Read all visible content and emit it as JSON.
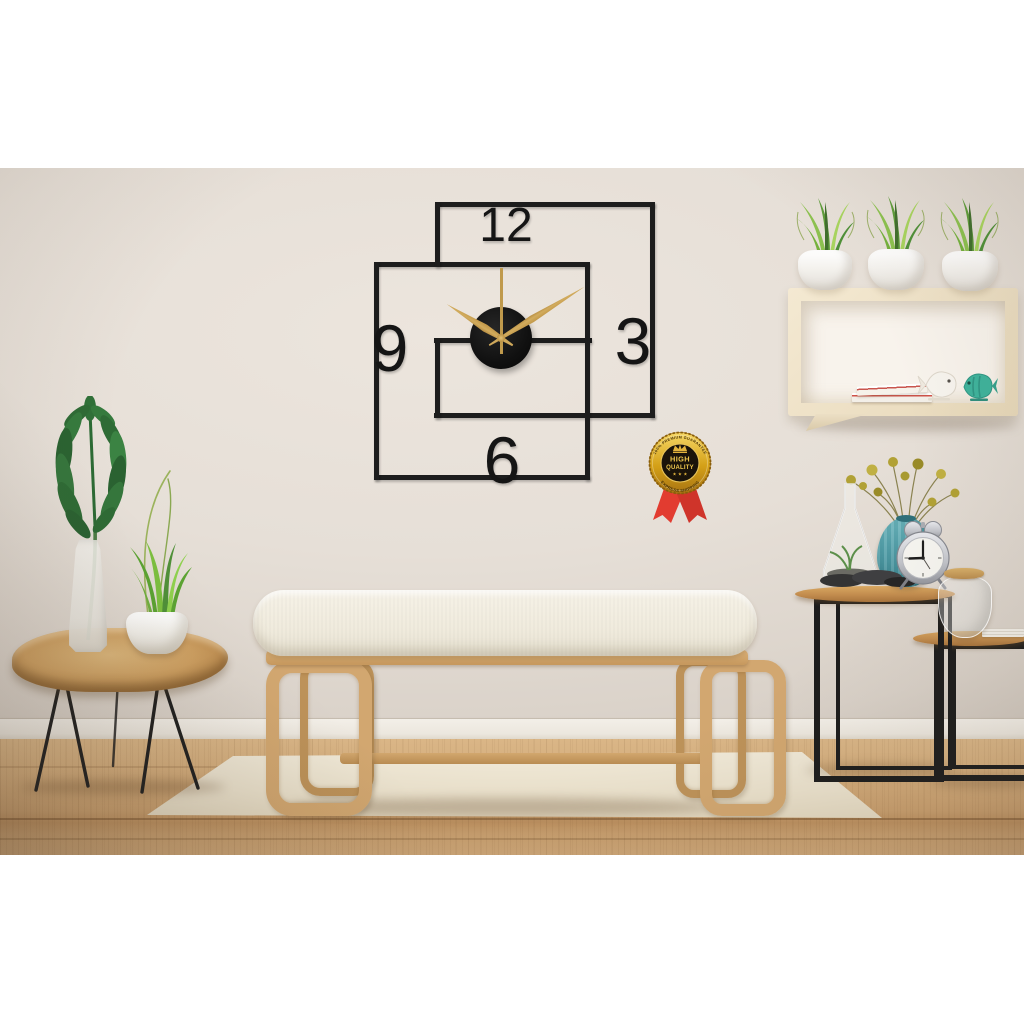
{
  "photo": {
    "wall_clock": {
      "numerals": {
        "twelve": "12",
        "three": "3",
        "six": "6",
        "nine": "9"
      },
      "time": {
        "hour": 10,
        "minute": 9,
        "second": 0
      },
      "frame_color": "#1d1d1d",
      "hands_color": "#c09a4c",
      "disc_color": "#121212"
    },
    "badge": {
      "arc_top": "100% PREMIUM GUARANTEE",
      "title_line1": "HIGH",
      "title_line2": "QUALITY",
      "stars": "★ ★ ★",
      "arc_bottom": "EXPRESS SHIPPING",
      "gold": "#d4a017",
      "ribbon_red": "#e23c30",
      "center_dark": "#1a130a"
    },
    "alarm_clock": {
      "time_shown": "9:00"
    },
    "palette": {
      "wall": "#e6dfd7",
      "skirting": "#f0ece5",
      "floor_wood": "#cfa674",
      "rug": "#ebe2cd",
      "bench_wood": "#d2a770",
      "cushion": "#f2eee2",
      "shelf_wood": "#eee0c6",
      "side_table_wood": "#c28c4e",
      "metal_leg_black": "#1c1c1c",
      "monstera_green": "#2e6b35",
      "grass_green": "#7cb844",
      "vase_teal": "#4d9aa4",
      "flower_yellow": "#b1a135",
      "alarm_silver": "#c9cacf"
    }
  }
}
